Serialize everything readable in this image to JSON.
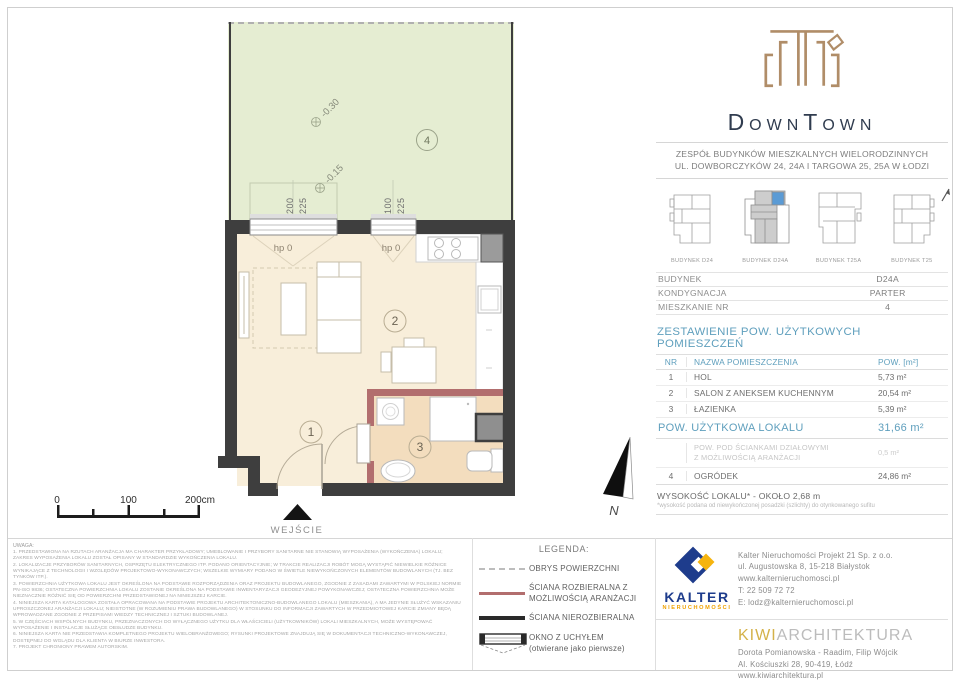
{
  "colors": {
    "brand_gold": "#b08d68",
    "brand_navy": "#303c4f",
    "table_teal": "#5f9fbd",
    "garden_green": "#e5edd2",
    "floor_cream": "#f8eeda",
    "bath_tan": "#f3ddbe",
    "wall_dark": "#3e3e3e",
    "wall_red": "#b26e6e",
    "kalter_blue": "#1e3c8c",
    "kalter_yellow": "#f6b40e",
    "kiwi_gold": "#d4b24a",
    "highlight_blue": "#5b9bd5"
  },
  "plan": {
    "rooms": {
      "hol": "1",
      "salon": "2",
      "lazienka": "3",
      "ogrodek": "4"
    },
    "window_label_left": "hp 0",
    "window_label_right": "hp 0",
    "garden_levels": {
      "upper": "-0.30",
      "lower": "-0.15"
    },
    "dims": {
      "w1a": "200",
      "w1b": "225",
      "w2a": "100",
      "w2b": "225"
    },
    "entrance_label": "WEJŚCIE",
    "scale": {
      "t0": "0",
      "t1": "100",
      "t2": "200cm"
    },
    "north_label": "N"
  },
  "header": {
    "brand": "DownTown",
    "address_line1": "ZESPÓŁ BUDYNKÓW MIESZKALNYCH WIELORODZINNYCH",
    "address_line2": "UL. DOWBORCZYKÓW 24, 24A I TARGOWA 25, 25A W ŁODZI"
  },
  "buildings": {
    "items": [
      {
        "label": "BUDYNEK D24"
      },
      {
        "label": "BUDYNEK D24A"
      },
      {
        "label": "BUDYNEK T25A"
      },
      {
        "label": "BUDYNEK T25"
      }
    ]
  },
  "info": {
    "rows": [
      {
        "label": "BUDYNEK",
        "value": "D24A"
      },
      {
        "label": "KONDYGNACJA",
        "value": "PARTER"
      },
      {
        "label": "MIESZKANIE NR",
        "value": "4"
      }
    ]
  },
  "area_table": {
    "title": "ZESTAWIENIE POW. UŻYTKOWYCH POMIESZCZEŃ",
    "col_nr": "NR",
    "col_name": "NAZWA POMIESZCZENIA",
    "col_area": "POW. [m²]",
    "rows": [
      {
        "nr": "1",
        "name": "HOL",
        "area": "5,73 m²"
      },
      {
        "nr": "2",
        "name": "SALON Z ANEKSEM KUCHENNYM",
        "area": "20,54 m²"
      },
      {
        "nr": "3",
        "name": "ŁAZIENKA",
        "area": "5,39 m²"
      }
    ],
    "total_label": "POW. UŻYTKOWA LOKALU",
    "total_value": "31,66 m²",
    "partition_line1": "POW. POD ŚCIANKAMI DZIAŁOWYMI",
    "partition_line2": "Z MOŻLIWOŚCIĄ ARANŻACJI",
    "partition_value": "0,5 m²",
    "garden_row": {
      "nr": "4",
      "name": "OGRÓDEK",
      "area": "24,86 m²"
    },
    "height_line": "WYSOKOŚĆ LOKALU* - OKOŁO 2,68 m",
    "height_footnote": "*wysokość podana od niewykończonej posadzki (szlichty) do otynkowanego sufitu"
  },
  "legend": {
    "title": "LEGENDA:",
    "obrys": "OBRYS POWIERZCHNI",
    "rozbieralna_1": "ŚCIANA ROZBIERALNA Z",
    "rozbieralna_2": "MOŻLIWOŚCIĄ ARANŻACJI",
    "nierozbieralna": "ŚCIANA NIEROZBIERALNA",
    "okno_1": "OKNO Z UCHYŁEM",
    "okno_2": "(otwierane jako pierwsze)"
  },
  "notes": {
    "title": "UWAGA:",
    "items": [
      "1. PRZEDSTAWIONA NA RZUTACH ARANŻACJA MA CHARAKTER PRZYKŁADOWY; UMEBLOWANIE I PRZYBORY SANITARNE NIE STANOWIĄ WYPOSAŻENIA (WYKOŃCZENIA) LOKALU; ZAKRES WYPOSAŻENIA LOKALU ZOSTAŁ OPISANY W STANDARDZIE WYKOŃCZENIA LOKALU.",
      "2. LOKALIZACJE PRZYBORÓW SANITARNYCH, OSPRZĘTU ELEKTRYCZNEGO ITP. PODANO ORIENTACYJNIE; W TRAKCIE REALIZACJI ROBÓT MOGĄ WYSTĄPIĆ NIEWIELKIE RÓŻNICE WYNIKAJĄCE Z TECHNOLOGII I WZGLĘDÓW PROJEKTOWO-WYKONAWCZYCH; WSZELKIE WYMIARY PODANO W ŚWIETLE NIEWYKOŃCZONYCH ELEMENTÓW BUDOWLANYCH (TJ. BEZ TYNKÓW ITP.).",
      "3. POWIERZCHNIA UŻYTKOWA LOKALU JEST OKREŚLONA NA PODSTAWIE ROZPORZĄDZENIA ORAZ PROJEKTU BUDOWLANEGO, ZGODNIE Z ZASADAMI ZAWARTYMI W POLSKIEJ NORMIE PN-ISO 9836; OSTATECZNA POWIERZCHNIA LOKALU ZOSTANIE OKREŚLONA NA PODSTAWIE INWENTARYZACJI GEODEZYJNEJ POWYKONAWCZEJ; OSTATECZNA POWIERZCHNIA MOŻE NIEZNACZNIE RÓŻNIĆ SIĘ OD POWIERZCHNI PRZEDSTAWIONEJ NA NINIEJSZEJ KARCIE.",
      "4. NINIEJSZA KARTA KATALOGOWA ZOSTAŁA OPRACOWANA NA PODSTAWIE PROJEKTU ARCHITEKTONICZNO-BUDOWLANEGO LOKALU (MIESZKANIA), A MA JEDYNIE SŁUŻYĆ WSKAZANIU UPROSZCZONEJ ARANŻACJI LOKALU; NIEISTOTNE (W ROZUMIENIU PRAWA BUDOWLANEGO) W STOSUNKU DO INFORMACJI ZAWARTYCH W PRZEDMIOTOWEJ KARCIE ZMIANY BĘDĄ WPROWADZANE ZGODNIE Z PRZEPISAMI WIEDZY TECHNICZNEJ I SZTUKI BUDOWLANEJ.",
      "5. W CZĘŚCIACH WSPÓLNYCH BUDYNKU, PRZEZNACZONYCH DO WYŁĄCZNEGO UŻYTKU DLA WŁAŚCICIELI (UŻYTKOWNIKÓW) LOKALI MIESZKALNYCH, MOŻE WYSTĘPOWAĆ WYPOSAŻENIE I INSTALACJE SŁUŻĄCE OBSŁUDZE BUDYNKU.",
      "6. NINIEJSZA KARTA NIE PRZEDSTAWIA KOMPLETNEGO PROJEKTU WIELOBRANŻOWEGO; RYSUNKI PROJEKTOWE ZNAJDUJĄ SIĘ W DOKUMENTACJI TECHNICZNO-WYKONAWCZEJ, DOSTĘPNEJ DO WGLĄDU DLA KLIENTA W BIURZE INWESTORA.",
      "7. PROJEKT CHRONIONY PRAWEM AUTORSKIM."
    ]
  },
  "kalter": {
    "name": "KALTER",
    "sub": "NIERUCHOMOŚCI",
    "lines": [
      "Kalter Nieruchomości Projekt 21 Sp. z o.o.",
      "ul. Augustowska 8, 15-218 Białystok",
      "www.kalternieruchomosci.pl",
      "T: 22 509 72 72",
      "E: lodz@kalternieruchomosci.pl"
    ]
  },
  "kiwi": {
    "brand_accent": "KIWI",
    "brand_rest": "ARCHITEKTURA",
    "lines": [
      "Dorota Pomianowska - Raadim, Filip Wójcik",
      "Al. Kościuszki 28, 90-419, Łódź",
      "www.kiwiarchitektura.pl"
    ]
  }
}
